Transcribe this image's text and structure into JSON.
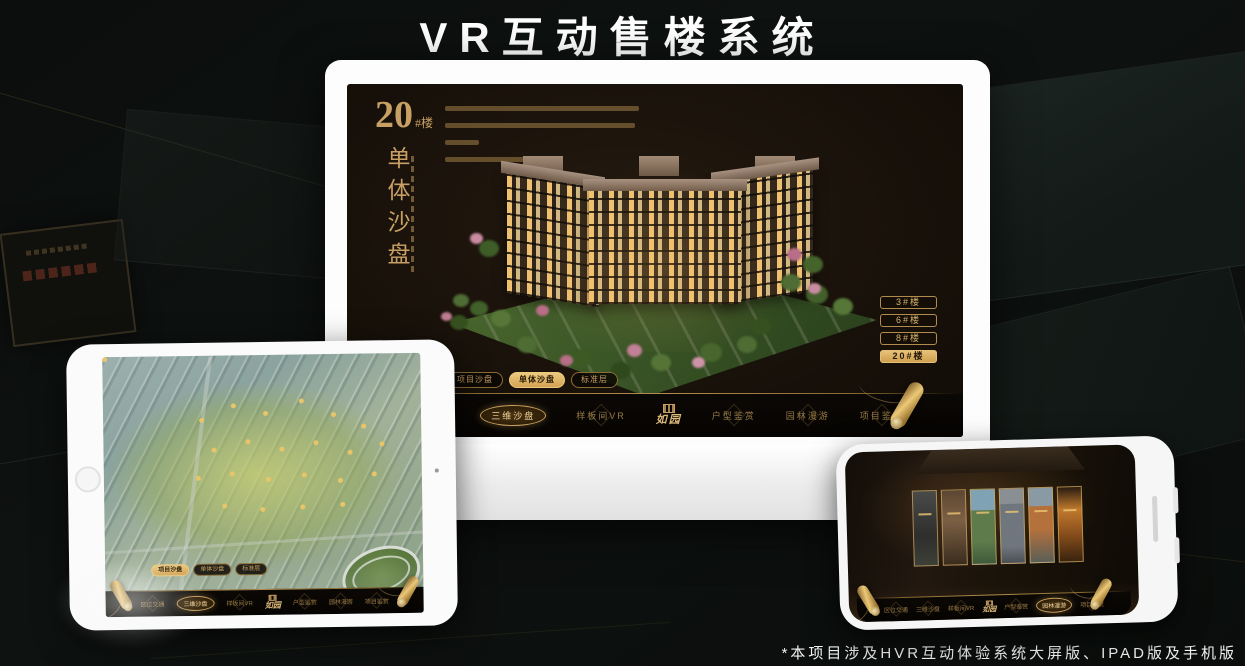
{
  "page": {
    "title": "VR互动售楼系统",
    "footnote": "*本项目涉及HVR互动体验系统大屏版、IPAD版及手机版"
  },
  "brand": {
    "logo": "如园",
    "accent_gold": "#C9A063",
    "highlight_gold": "#D8AE62",
    "screen_background": "#18110A"
  },
  "menu": {
    "items": [
      {
        "label": "区位交通"
      },
      {
        "label": "三维沙盘"
      },
      {
        "label": "样板间VR"
      },
      {
        "label": "户型鉴赏"
      },
      {
        "label": "园林漫游"
      },
      {
        "label": "项目鉴赏"
      }
    ]
  },
  "sub_tabs": {
    "items": [
      {
        "label": "项目沙盘"
      },
      {
        "label": "单体沙盘"
      },
      {
        "label": "标准层"
      }
    ]
  },
  "desktop": {
    "block_number": "20",
    "block_unit": "#楼",
    "section_vertical_title": "单体沙盘",
    "active_sub_tab": "单体沙盘",
    "active_menu_item": "三维沙盘",
    "building_buttons": [
      {
        "label": "3#楼"
      },
      {
        "label": "6#楼"
      },
      {
        "label": "8#楼"
      },
      {
        "label": "20#楼"
      }
    ],
    "active_building_button": "20#楼"
  },
  "tablet": {
    "active_sub_tab": "项目沙盘",
    "active_menu_item": "三维沙盘"
  },
  "phone": {
    "active_menu_item": "园林漫游",
    "gallery_card_count": 6
  }
}
